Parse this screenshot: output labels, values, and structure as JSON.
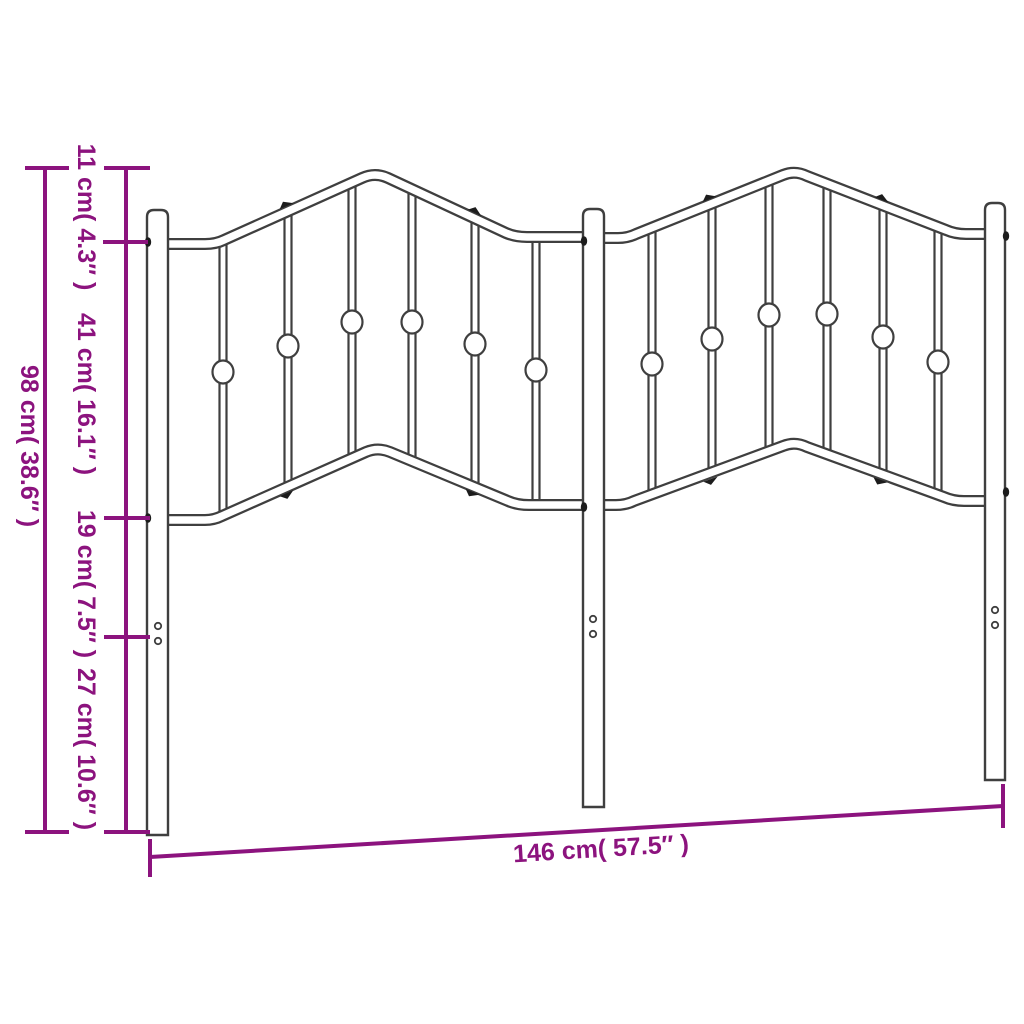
{
  "diagram": {
    "title": "Metal headboard dimension diagram",
    "colors": {
      "dimension": "#8C137E",
      "outline": "#3F3F3F",
      "detail": "#1C1C1C",
      "background": "#FFFFFF"
    },
    "vertical_dimensions": {
      "total_height": "98 cm( 38.6″ )",
      "peak_to_top_rail": "11 cm( 4.3″ )",
      "panel_height": "41 cm( 16.1″ )",
      "rail_to_holes": "19 cm( 7.5″ )",
      "holes_to_floor": "27 cm( 10.6″ )"
    },
    "horizontal_dimensions": {
      "total_width": "146 cm( 57.5″ )"
    }
  }
}
